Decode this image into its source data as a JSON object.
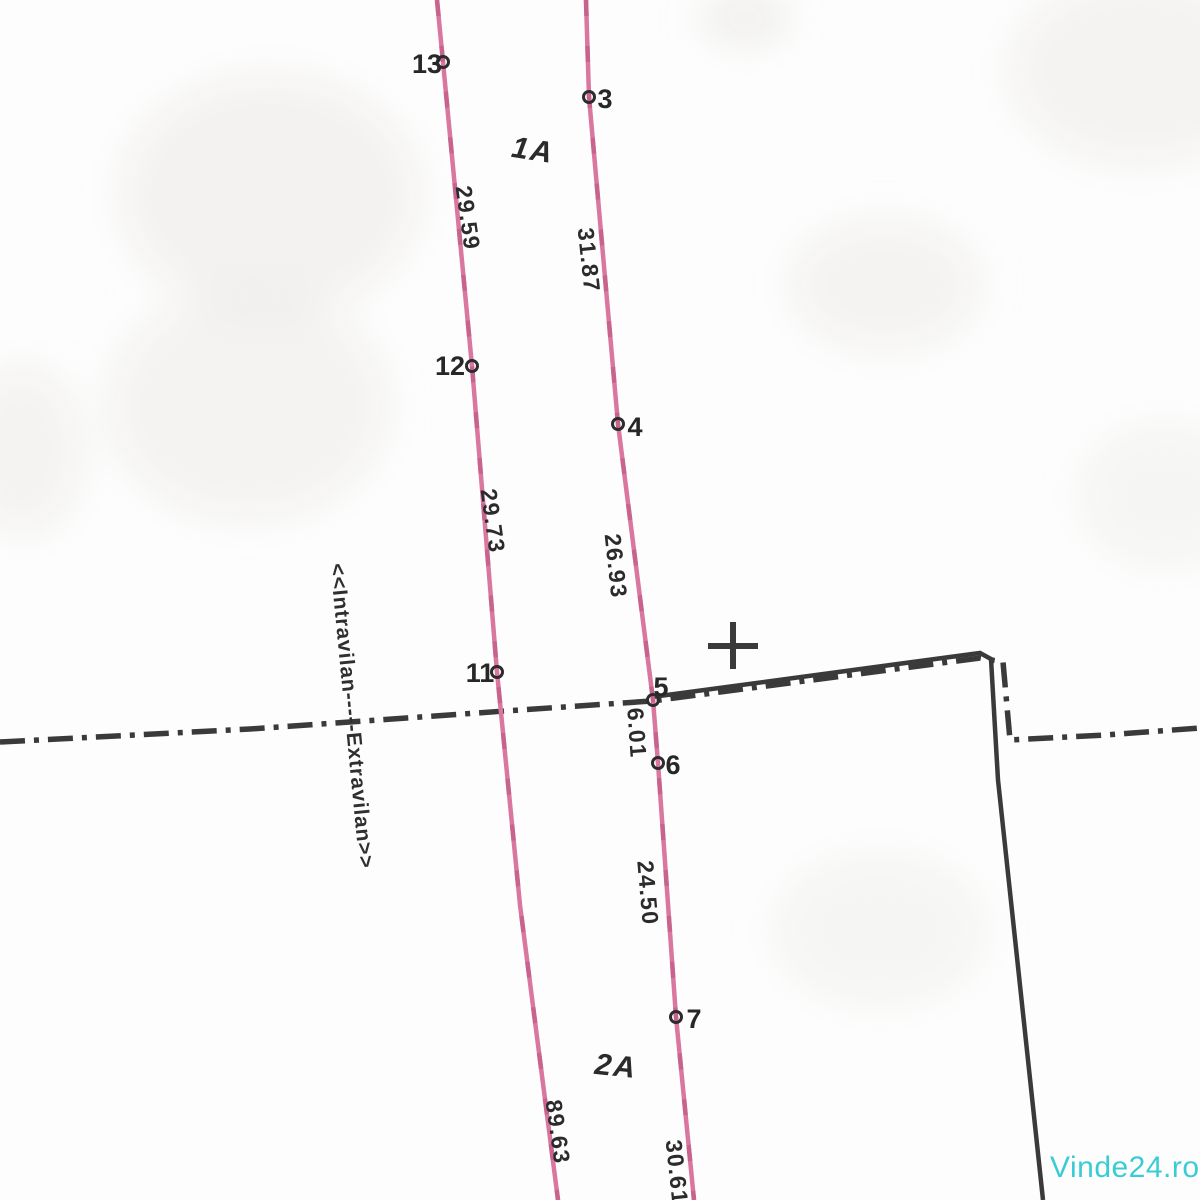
{
  "map": {
    "title": "cadastral-parcel-plan",
    "colors": {
      "background": "#fdfdfd",
      "ink": "#3a3a3a",
      "parcel_line": "#d9779f",
      "parcel_line_dark": "#c05c86",
      "watermark": "#3accd4"
    },
    "watermark": {
      "text": "Vinde24.ro",
      "x": 1050,
      "y": 1177
    },
    "zone_boundary_label": {
      "text": "<<Intravilan-----Extravilan>>",
      "x": 352,
      "y": 716,
      "angle": 84.5
    },
    "parcels": [
      {
        "label": "1A",
        "x": 533,
        "y": 150,
        "angle": 9
      },
      {
        "label": "2A",
        "x": 616,
        "y": 1066,
        "angle": 6
      }
    ],
    "survey_points": [
      {
        "id": "13",
        "cx": 443,
        "cy": 62,
        "lx": 427,
        "ly": 64
      },
      {
        "id": "3",
        "cx": 589,
        "cy": 97,
        "lx": 605,
        "ly": 99
      },
      {
        "id": "12",
        "cx": 472,
        "cy": 366,
        "lx": 450,
        "ly": 366
      },
      {
        "id": "4",
        "cx": 618,
        "cy": 424,
        "lx": 635,
        "ly": 427
      },
      {
        "id": "11",
        "cx": 497,
        "cy": 672,
        "lx": 480,
        "ly": 673
      },
      {
        "id": "5",
        "cx": 653,
        "cy": 700,
        "lx": 661,
        "ly": 687
      },
      {
        "id": "6",
        "cx": 658,
        "cy": 763,
        "lx": 673,
        "ly": 765
      },
      {
        "id": "7",
        "cx": 676,
        "cy": 1017,
        "lx": 694,
        "ly": 1019
      }
    ],
    "measurements": [
      {
        "value": "29.59",
        "x": 468,
        "y": 218,
        "angle": 82
      },
      {
        "value": "31.87",
        "x": 589,
        "y": 260,
        "angle": 84
      },
      {
        "value": "29.73",
        "x": 493,
        "y": 521,
        "angle": 82
      },
      {
        "value": "26.93",
        "x": 616,
        "y": 566,
        "angle": 84
      },
      {
        "value": "6.01",
        "x": 637,
        "y": 733,
        "angle": 86
      },
      {
        "value": "24.50",
        "x": 648,
        "y": 893,
        "angle": 85
      },
      {
        "value": "89.63",
        "x": 558,
        "y": 1132,
        "angle": 82
      },
      {
        "value": "30.61",
        "x": 677,
        "y": 1172,
        "angle": 84
      }
    ],
    "lines": {
      "parcel_left": [
        [
          437,
          0
        ],
        [
          443,
          62
        ],
        [
          472,
          366
        ],
        [
          497,
          672
        ],
        [
          520,
          905
        ],
        [
          558,
          1200
        ]
      ],
      "parcel_right": [
        [
          586,
          0
        ],
        [
          589,
          97
        ],
        [
          618,
          424
        ],
        [
          653,
          700
        ],
        [
          658,
          763
        ],
        [
          676,
          1017
        ],
        [
          694,
          1200
        ]
      ],
      "admin_boundary": [
        [
          0,
          742
        ],
        [
          250,
          729
        ],
        [
          505,
          711
        ],
        [
          652,
          701
        ],
        [
          980,
          658
        ],
        [
          1003,
          662
        ],
        [
          1010,
          740
        ],
        [
          1105,
          735
        ],
        [
          1200,
          728
        ]
      ],
      "property_boundary": [
        [
          652,
          697
        ],
        [
          980,
          653
        ],
        [
          991,
          659
        ],
        [
          998,
          780
        ],
        [
          1043,
          1200
        ]
      ],
      "grid_cross": {
        "x": 733,
        "y": 645,
        "arm": 25
      }
    }
  }
}
